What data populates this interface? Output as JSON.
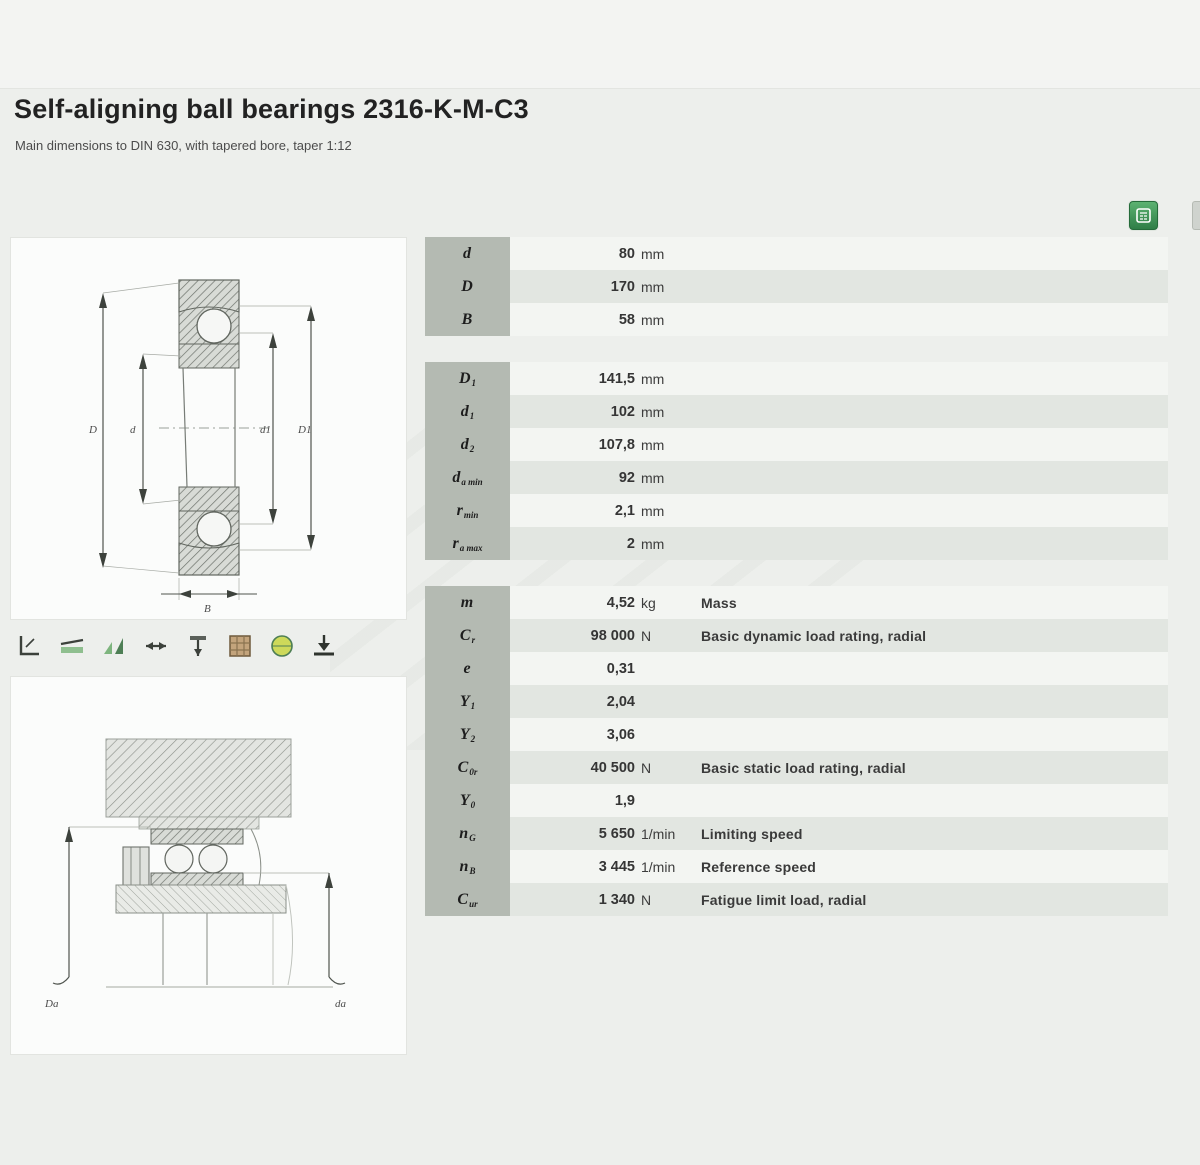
{
  "page": {
    "title": "Self-aligning ball bearings 2316-K-M-C3",
    "subtitle": "Main dimensions to DIN 630, with tapered bore, taper 1:12"
  },
  "actions": {
    "calc_button": "calculator-icon",
    "edge_button": "side-panel-icon"
  },
  "feature_icons": [
    "angle-icon",
    "alignment-icon",
    "speed-icon",
    "axial-load-icon",
    "radial-load-icon",
    "cage-grid-icon",
    "globe-icon",
    "cad-download-icon"
  ],
  "table": {
    "note": "Dimensions",
    "blocks": [
      {
        "rows": [
          {
            "sym": "d",
            "sub": "",
            "value": "80",
            "unit": "mm",
            "desc": ""
          },
          {
            "sym": "D",
            "sub": "",
            "value": "170",
            "unit": "mm",
            "desc": ""
          },
          {
            "sym": "B",
            "sub": "",
            "value": "58",
            "unit": "mm",
            "desc": ""
          }
        ]
      },
      {
        "rows": [
          {
            "sym": "D",
            "sub": "1",
            "value": "141,5",
            "unit": "mm",
            "desc": ""
          },
          {
            "sym": "d",
            "sub": "1",
            "value": "102",
            "unit": "mm",
            "desc": ""
          },
          {
            "sym": "d",
            "sub": "2",
            "value": "107,8",
            "unit": "mm",
            "desc": ""
          },
          {
            "sym": "d",
            "sub": "a min",
            "value": "92",
            "unit": "mm",
            "desc": ""
          },
          {
            "sym": "r",
            "sub": "min",
            "value": "2,1",
            "unit": "mm",
            "desc": ""
          },
          {
            "sym": "r",
            "sub": "a max",
            "value": "2",
            "unit": "mm",
            "desc": ""
          }
        ]
      },
      {
        "rows": [
          {
            "sym": "m",
            "sub": "",
            "value": "4,52",
            "unit": "kg",
            "desc": "Mass"
          },
          {
            "sym": "C",
            "sub": "r",
            "value": "98 000",
            "unit": "N",
            "desc": "Basic dynamic load rating, radial"
          },
          {
            "sym": "e",
            "sub": "",
            "value": "0,31",
            "unit": "",
            "desc": ""
          },
          {
            "sym": "Y",
            "sub": "1",
            "value": "2,04",
            "unit": "",
            "desc": ""
          },
          {
            "sym": "Y",
            "sub": "2",
            "value": "3,06",
            "unit": "",
            "desc": ""
          },
          {
            "sym": "C",
            "sub": "0r",
            "value": "40 500",
            "unit": "N",
            "desc": "Basic static load rating, radial"
          },
          {
            "sym": "Y",
            "sub": "0",
            "value": "1,9",
            "unit": "",
            "desc": ""
          },
          {
            "sym": "n",
            "sub": "G",
            "value": "5 650",
            "unit": "1/min",
            "desc": "Limiting speed"
          },
          {
            "sym": "n",
            "sub": "B",
            "value": "3 445",
            "unit": "1/min",
            "desc": "Reference speed"
          },
          {
            "sym": "C",
            "sub": "ur",
            "value": "1 340",
            "unit": "N",
            "desc": "Fatigue limit load, radial"
          }
        ]
      }
    ]
  },
  "drawings": {
    "section_labels": {
      "outer": "D",
      "bore": "d",
      "shoulder_inner": "d1",
      "shoulder_outer": "D1",
      "width": "B"
    },
    "mounting_labels": {
      "housing": "Da",
      "shaft": "da"
    }
  }
}
